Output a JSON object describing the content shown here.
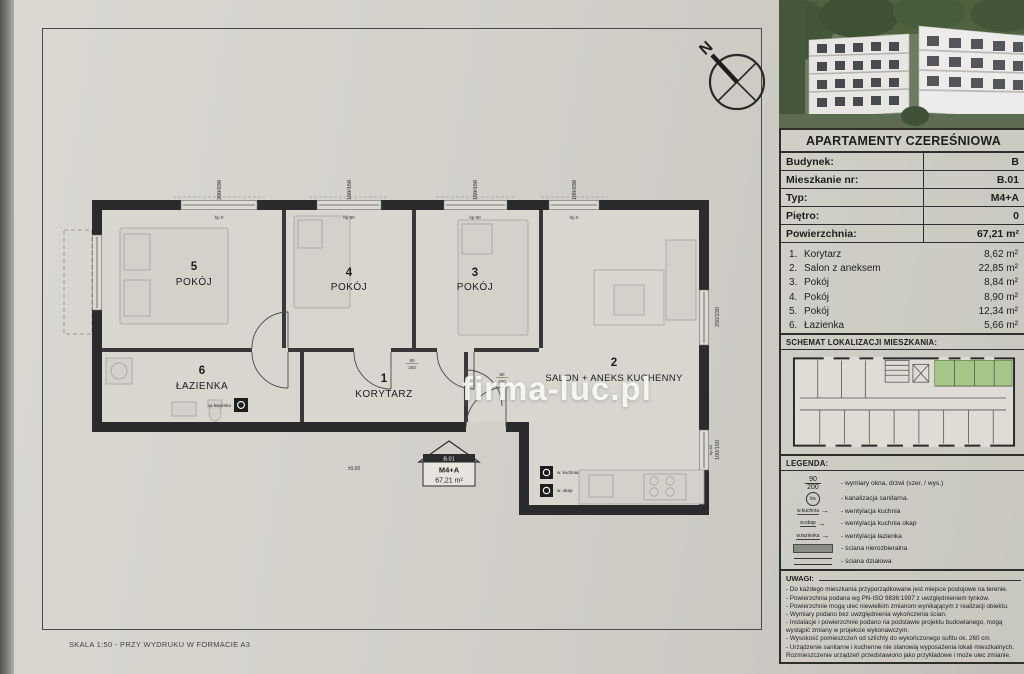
{
  "page": {
    "watermark": "firma-luc.pl",
    "scale_note": "SKALA 1:50 - PRZY WYDRUKU W FORMACIE A3",
    "north_label": "N"
  },
  "title_block": {
    "title": "APARTAMENTY CZEREŚNIOWA",
    "rows": [
      {
        "label": "Budynek:",
        "value": "B"
      },
      {
        "label": "Mieszkanie nr:",
        "value": "B.01"
      },
      {
        "label": "Typ:",
        "value": "M4+A"
      },
      {
        "label": "Piętro:",
        "value": "0"
      },
      {
        "label": "Powierzchnia:",
        "value": "67,21 m²"
      }
    ]
  },
  "room_list": [
    {
      "no": "1.",
      "name": "Korytarz",
      "area": "8,62 m²"
    },
    {
      "no": "2.",
      "name": "Salon z aneksem",
      "area": "22,85 m²"
    },
    {
      "no": "3.",
      "name": "Pokój",
      "area": "8,84 m²"
    },
    {
      "no": "4.",
      "name": "Pokój",
      "area": "8,90 m²"
    },
    {
      "no": "5.",
      "name": "Pokój",
      "area": "12,34 m²"
    },
    {
      "no": "6.",
      "name": "Łazienka",
      "area": "5,66 m²"
    }
  ],
  "plan": {
    "rooms": {
      "r5": {
        "no": "5",
        "name": "POKÓJ"
      },
      "r4": {
        "no": "4",
        "name": "POKÓJ"
      },
      "r3": {
        "no": "3",
        "name": "POKÓJ"
      },
      "r6": {
        "no": "6",
        "name": "ŁAZIENKA"
      },
      "r1": {
        "no": "1",
        "name": "KORYTARZ"
      },
      "r2": {
        "no": "2",
        "name": "SALON + ANEKS KUCHENNY"
      }
    },
    "badge": {
      "unit": "B.01",
      "type": "M4+A",
      "area": "67,21 m²"
    },
    "level_mark": "±0,00",
    "top_windows": [
      {
        "dim": "200/230",
        "hp": "hp 0"
      },
      {
        "dim": "160/150",
        "hp": "hp 80"
      },
      {
        "dim": "160/150",
        "hp": "hp 80"
      },
      {
        "dim": "100/230",
        "hp": "hp 0"
      }
    ],
    "right_windows": [
      {
        "dim": "250/230"
      },
      {
        "dim": "100/150",
        "hp": "hp 80"
      }
    ],
    "door_dim_top": "80",
    "door_dim_bottom": "200",
    "vents": {
      "kitchen": "w. kuchnia",
      "hood": "w. okap",
      "bath": "w. łazienka"
    }
  },
  "location": {
    "heading": "SCHEMAT LOKALIZACJI MIESZKANIA:",
    "highlight_color": "#a6c687"
  },
  "legend": {
    "heading": "LEGENDA:",
    "window_dim_symbol": {
      "top": "90",
      "bottom": "200"
    },
    "items": [
      {
        "label": "- wymiary okna, drzwi (szer. / wys.)"
      },
      {
        "symbol": "ks",
        "label": "- kanalizacja sanitarna."
      },
      {
        "symbol": "w.kuchnia",
        "label": "- wentylacja kuchnia"
      },
      {
        "symbol": "w.okap",
        "label": "- wentylacja kuchnia okap"
      },
      {
        "symbol": "w.łazienka",
        "label": "- wentylacja łazienka"
      },
      {
        "label": "- ściana nierozbieralna"
      },
      {
        "label": "- ściana działowa"
      }
    ]
  },
  "uwagi": {
    "heading": "UWAGI:",
    "notes": [
      "- Do każdego mieszkania przyporządkowane jest miejsce postojowe na terenie.",
      "- Powierzchnia podana wg PN-ISO 9836:1997 z uwzględnieniem tynków.",
      "- Powierzchnie mogą ulec niewielkim zmianom wynikającym z realizacji obiektu.",
      "- Wymiary podano bez uwzględnienia wykończenia ścian.",
      "- Instalacje i powierzchnie podano na podstawie projektu budowlanego, mogą wystąpić zmiany w projekcie wykonawczym.",
      "- Wysokość pomieszczeń od szlichty do wykończonego sufitu ok. 260 cm",
      "- Urządzenie sanitarne i kuchenne nie stanowią wyposażenia lokali mieszkalnych. Rozmieszczenie urządzeń przedstawiono jako przykładowe i może ulec zmianie."
    ]
  }
}
